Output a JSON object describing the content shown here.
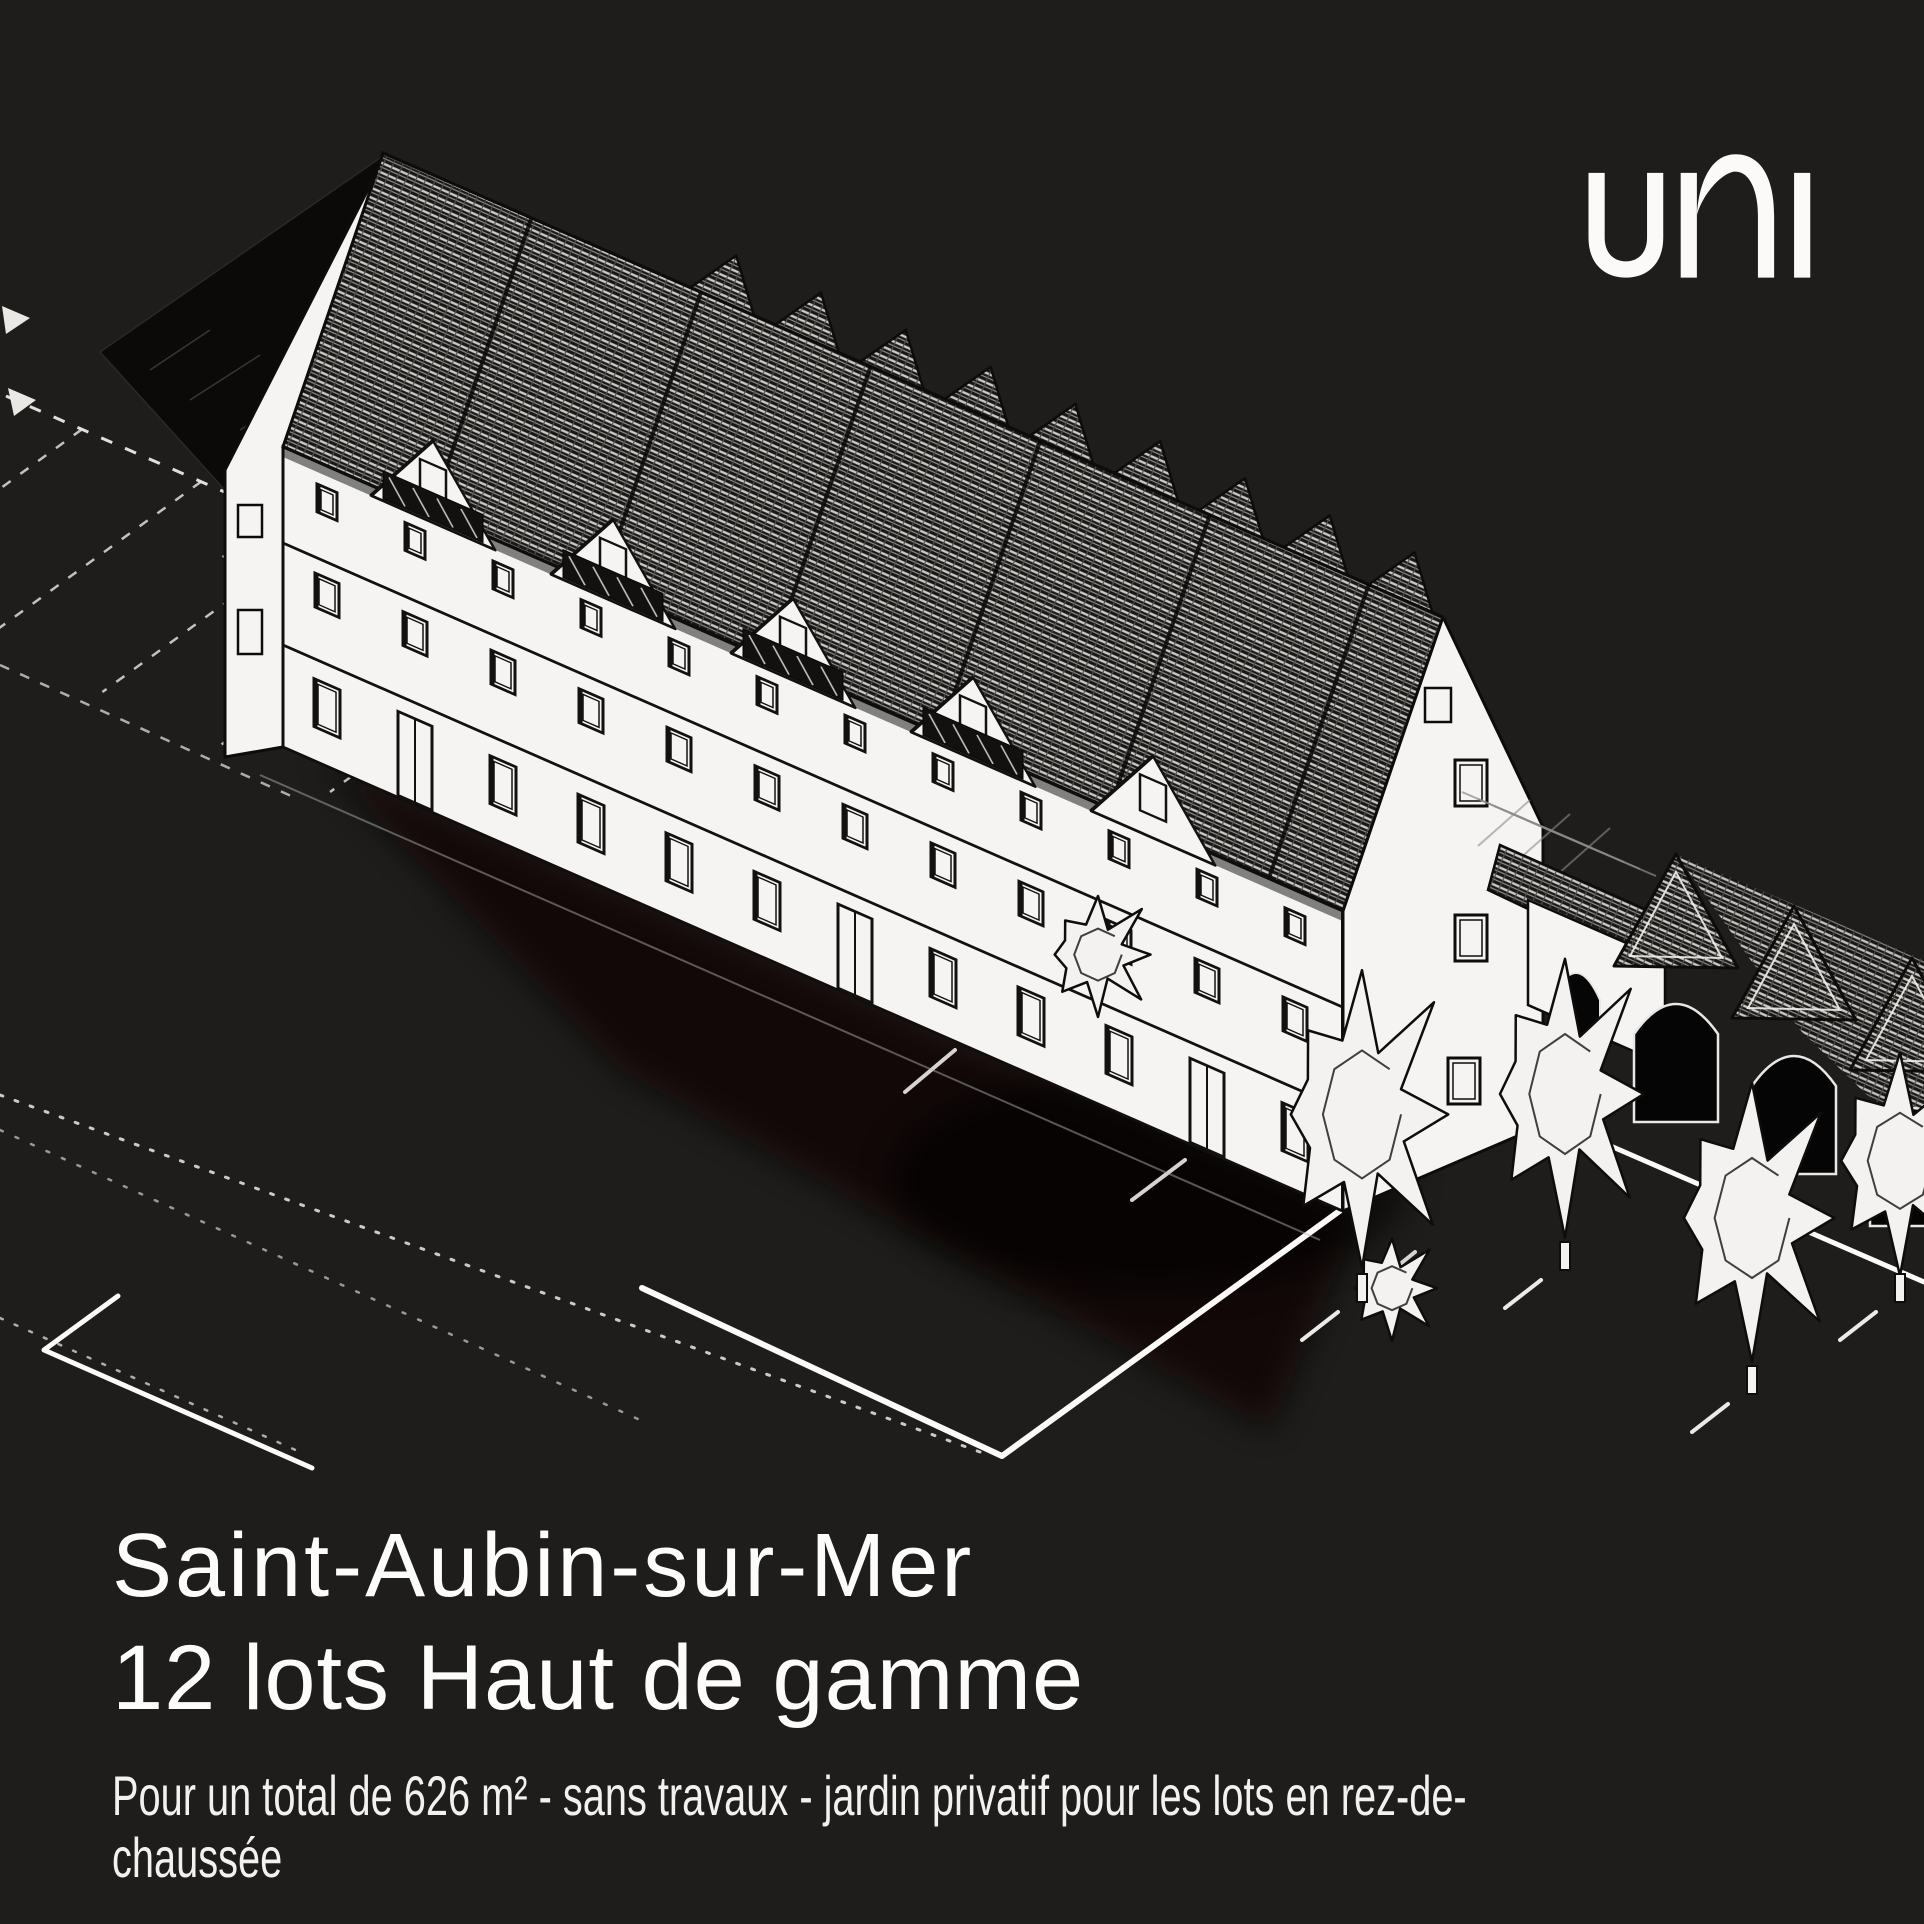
{
  "page": {
    "background_color": "#1e1d1b",
    "text_color": "#fcfcfb"
  },
  "brand": {
    "logo_text": "uni",
    "logo_color": "#fbfaf8"
  },
  "headline": {
    "line1": "Saint-Aubin-sur-Mer",
    "line2": "12 lots Haut de gamme"
  },
  "description": {
    "line1": "Pour un total de 626 m² - sans travaux - jardin privatif pour les lots en rez-de-",
    "line2": "chaussée",
    "full_text": "Pour un total de 626 m² - sans travaux - jardin privatif pour les lots en rez-de-chaussée"
  }
}
